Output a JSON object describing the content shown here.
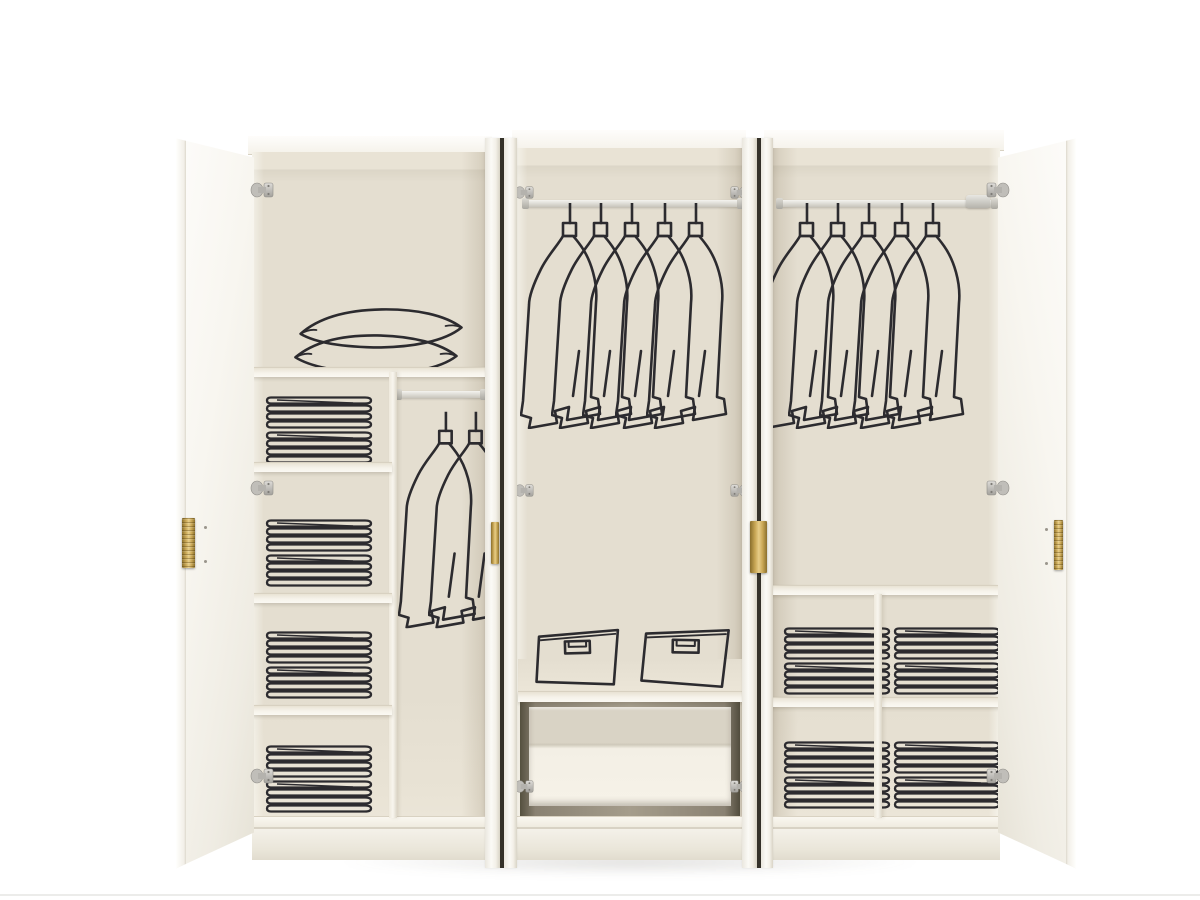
{
  "meta": {
    "type": "product-photograph",
    "subject": "White six-door wardrobe shown with doors open; interiors decorated with black line-art of hanging coats, folded towels, pillows and storage boxes",
    "no_visible_text": true
  },
  "colors": {
    "backdrop": "#ffffff",
    "cabinet-white": "#f7f5ef",
    "interior-back": "#e4ded0",
    "interior-ceiling": "#e9e3d5",
    "shelf-edge": "#d8d1c1",
    "drawer-recess": "#8a8273",
    "slit-dark": "#35322a",
    "line-art": "#2c2b2f",
    "handle-gold": "#c8a654",
    "handle-gold-light": "#e7cd88",
    "handle-gold-dark": "#8a6f2d",
    "hinge-silver": "#c0beb9"
  },
  "counts": {
    "doors_total": 6,
    "doors_open": 2,
    "doors_ajar": 4,
    "garments_middle": 5,
    "garments_right": 5,
    "garments_left": 2,
    "pillows": 2,
    "storage_boxes": 2,
    "drawers": 1,
    "towel_compartments_left": 4,
    "towel_cubbies_right": 4,
    "stacks_per_compartment": 2
  },
  "sections": [
    {
      "id": "left",
      "contents": [
        "two pillows on top shelf",
        "four shelf compartments each holding two stacks of folded towels",
        "short hanging rod with two garments"
      ]
    },
    {
      "id": "middle",
      "contents": [
        "full-width hanging rod with five garments",
        "two fabric storage boxes on a shelf",
        "one pull-out drawer"
      ]
    },
    {
      "id": "right",
      "contents": [
        "full-width hanging rod with five garments",
        "four cubbies each holding two stacks of folded towels"
      ]
    }
  ],
  "hardware": {
    "handle_finish": "brushed brass",
    "hinge_finish": "nickel"
  }
}
